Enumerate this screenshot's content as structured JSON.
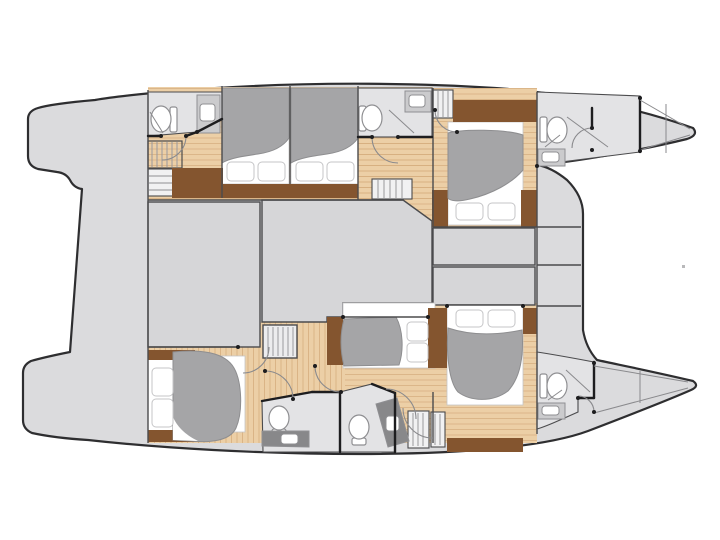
{
  "diagram": {
    "type": "floor-plan",
    "subject": "Catamaran interior deck plan, top-down view, bow pointing right",
    "hulls": 2,
    "double_berths": 6,
    "toilets": 6,
    "sinks": 6,
    "staircases": 2,
    "swim_platforms": 2,
    "regions": [
      "aft swim platform (upper hull)",
      "aft swim platform (lower hull)",
      "aft deck walkway",
      "salon / bridgedeck",
      "forward deck lockers",
      "upper hull aft bathroom",
      "upper hull staircase",
      "upper hull aft double cabin",
      "upper hull middle double cabin",
      "upper hull mid bathroom",
      "upper hull forward double cabin",
      "upper hull bow bathroom",
      "upper hull bow storage",
      "lower hull aft double cabin",
      "lower hull staircase",
      "lower hull bathroom 1",
      "lower hull bathroom 2",
      "lower hull middle double cabin",
      "lower hull forward double cabin",
      "lower hull bow bathroom",
      "lower hull bow storage"
    ]
  },
  "colors": {
    "background": "#ffffff",
    "deck": "#dbdbdd",
    "room": "#d6d6d8",
    "bath": "#e3e3e5",
    "stairs": "#ececee",
    "cabinet": "#f1f1f2",
    "wood_light": "#eccfa6",
    "wood_plank_line": "#d6ae7e",
    "wood_dark": "#84552f",
    "duvet": "#a5a5a7",
    "duvet_stroke": "#8e8e90",
    "linen": "#ffffff",
    "pillow_stroke": "#c5c5c7",
    "outline": "#2e2e30",
    "wall_thin": "#4b4b4d",
    "wall_thick": "#1d1d1f",
    "arc": "#8a8a8d",
    "fixture": "#8f8f92",
    "sink_fill": "#cbcbcd",
    "counter": "#88888a",
    "tread": "#9a9a9d",
    "speck": "#b9b9bb"
  }
}
